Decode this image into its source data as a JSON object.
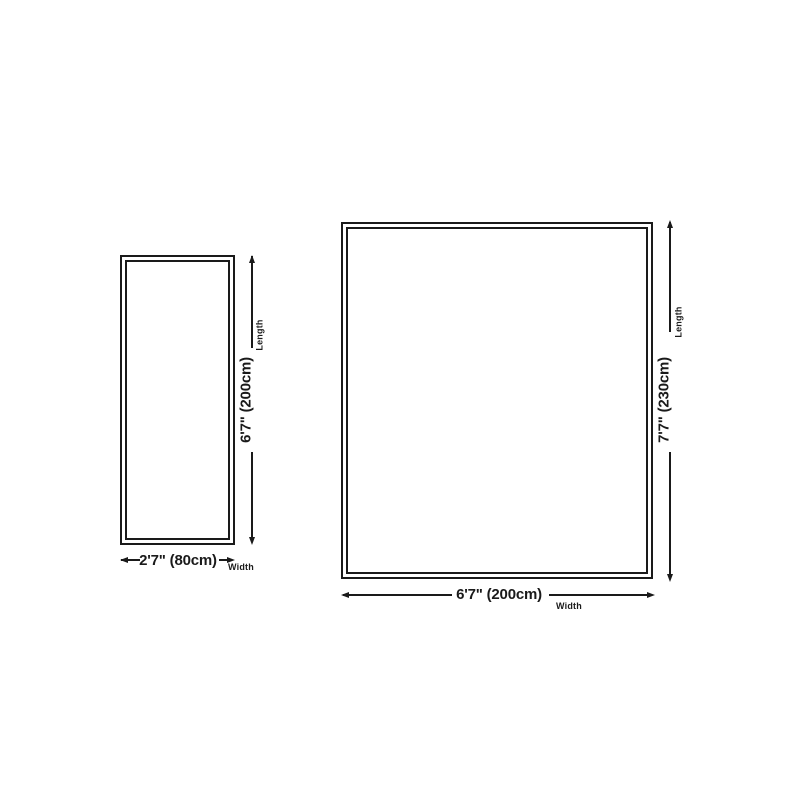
{
  "theme": {
    "bg": "#ffffff",
    "ink": "#1a1a1a"
  },
  "diagrams": {
    "small": {
      "length_value": "6'7\" (200cm)",
      "length_label": "Length",
      "width_value": "2'7\" (80cm)",
      "width_label": "Width"
    },
    "large": {
      "length_value": "7'7\" (230cm)",
      "length_label": "Length",
      "width_value": "6'7\" (200cm)",
      "width_label": "Width"
    }
  }
}
